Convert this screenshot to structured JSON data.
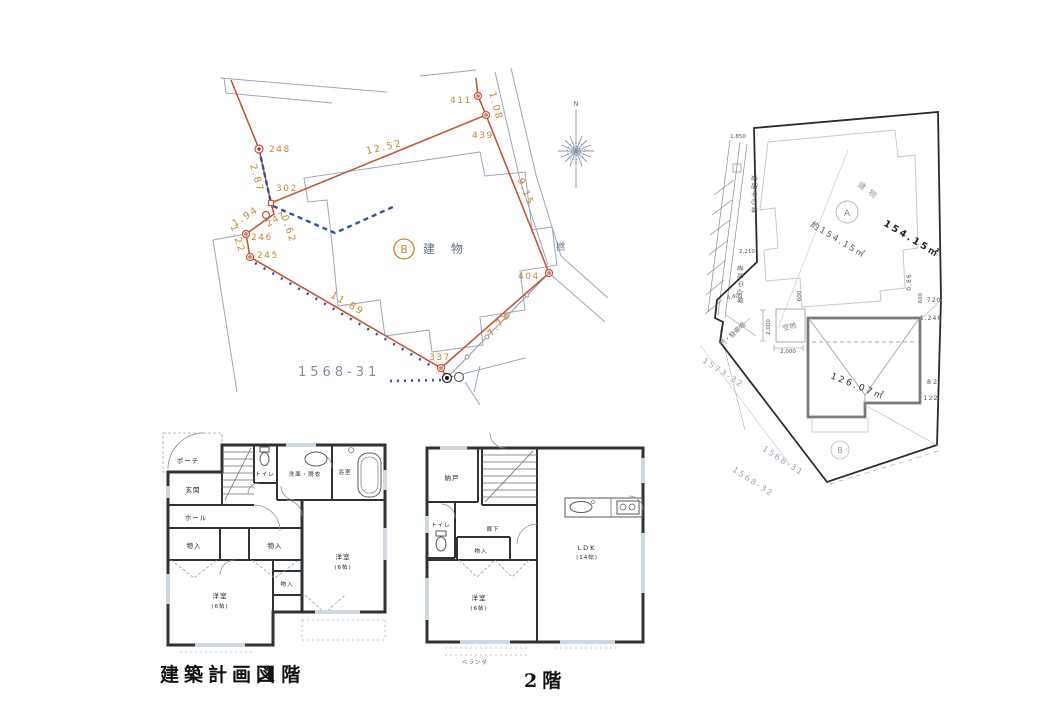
{
  "survey": {
    "north_label": "N",
    "points": {
      "p248": "248",
      "p302": "302",
      "p247": "247",
      "p246": "246",
      "p245": "245",
      "p411": "411",
      "p439": "439",
      "p404": "404",
      "p337": "337"
    },
    "dims": {
      "d12_52": "12.52",
      "d2_87": "2.87",
      "d1_94": "1.94",
      "d1_22": "1.22",
      "d0_62": "0.62",
      "d9_15": "9.15",
      "d11_89": "11.89",
      "d7_78": "7.78",
      "d1_08": "1.08"
    },
    "building_mark": "B",
    "building_label": "建 物",
    "parcel_no": "1568-31",
    "edge_text": "撚"
  },
  "siteplan": {
    "building_label": "建物",
    "mark_a": "A",
    "mark_b": "B",
    "area_a": "154.15㎡",
    "area_a_approx": "約154.15㎡",
    "area_b": "126.07㎡",
    "open_space_label": "空地",
    "gate_label": "門・駐車場",
    "road_center_label": "道路中心線",
    "dims": {
      "d1850": "1,850",
      "d2210": "2,210",
      "d4400": "4,400",
      "d2000": "2,000"
    },
    "edge_nums": {
      "n086": "0.86",
      "n600": "600",
      "n720": "720",
      "n1246": "1,246",
      "n82": "82",
      "n122": "122"
    },
    "parcels": {
      "p1573_32": "1573-32",
      "p1568_31": "1568-31",
      "p1568_32": "1568-32"
    }
  },
  "floor1": {
    "caption_title": "建築計画図",
    "caption_floor": "1階",
    "rooms": {
      "porch": "ポーチ",
      "entry": "玄関",
      "toilet": "トイレ",
      "washroom": "洗面・脱衣",
      "bath": "浴室",
      "hall": "ホール",
      "storage": "物入",
      "western_room": "洋室",
      "size_6": "(6帖)"
    }
  },
  "floor2": {
    "caption_floor": "2階",
    "rooms": {
      "closet": "納戸",
      "toilet": "トイレ",
      "corridor": "廊下",
      "storage": "物入",
      "western_room": "洋室",
      "size_6": "(6帖)",
      "ldk": "LDK",
      "size_14": "(14帖)",
      "veranda": "ベランダ"
    }
  },
  "colors": {
    "survey_line": "#c2573a",
    "survey_text": "#c8862e",
    "survey_blue": "#2f55a4",
    "survey_gray": "#8a97a8",
    "plan_wall": "#2e3338",
    "site_boundary": "#2b2b2b"
  }
}
